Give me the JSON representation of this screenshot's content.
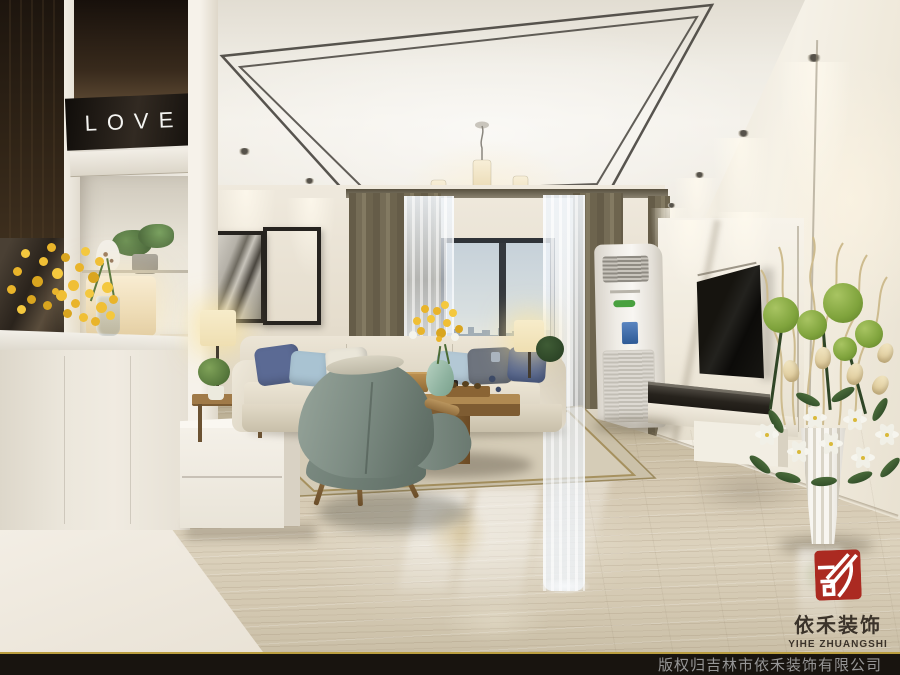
{
  "love_sign": {
    "text": "LOVE"
  },
  "brand": {
    "cn": "依禾装饰",
    "en": "YIHE ZHUANGSHI"
  },
  "footer": {
    "copyright": "版权归吉林市依禾装饰有限公司"
  },
  "colors": {
    "logo_red": "#ab2a21",
    "footer_bg": "#18140f",
    "footer_text": "#969696",
    "footer_accent": "#b99d3f",
    "curtain_olive": "#756c56",
    "wall_cream": "#efe9dd",
    "floor_beige": "#d4c8b1",
    "armchair_sage": "#7e8d84",
    "pillow_navy": "#5b6a94",
    "pillow_blue": "#a9c3d2"
  }
}
